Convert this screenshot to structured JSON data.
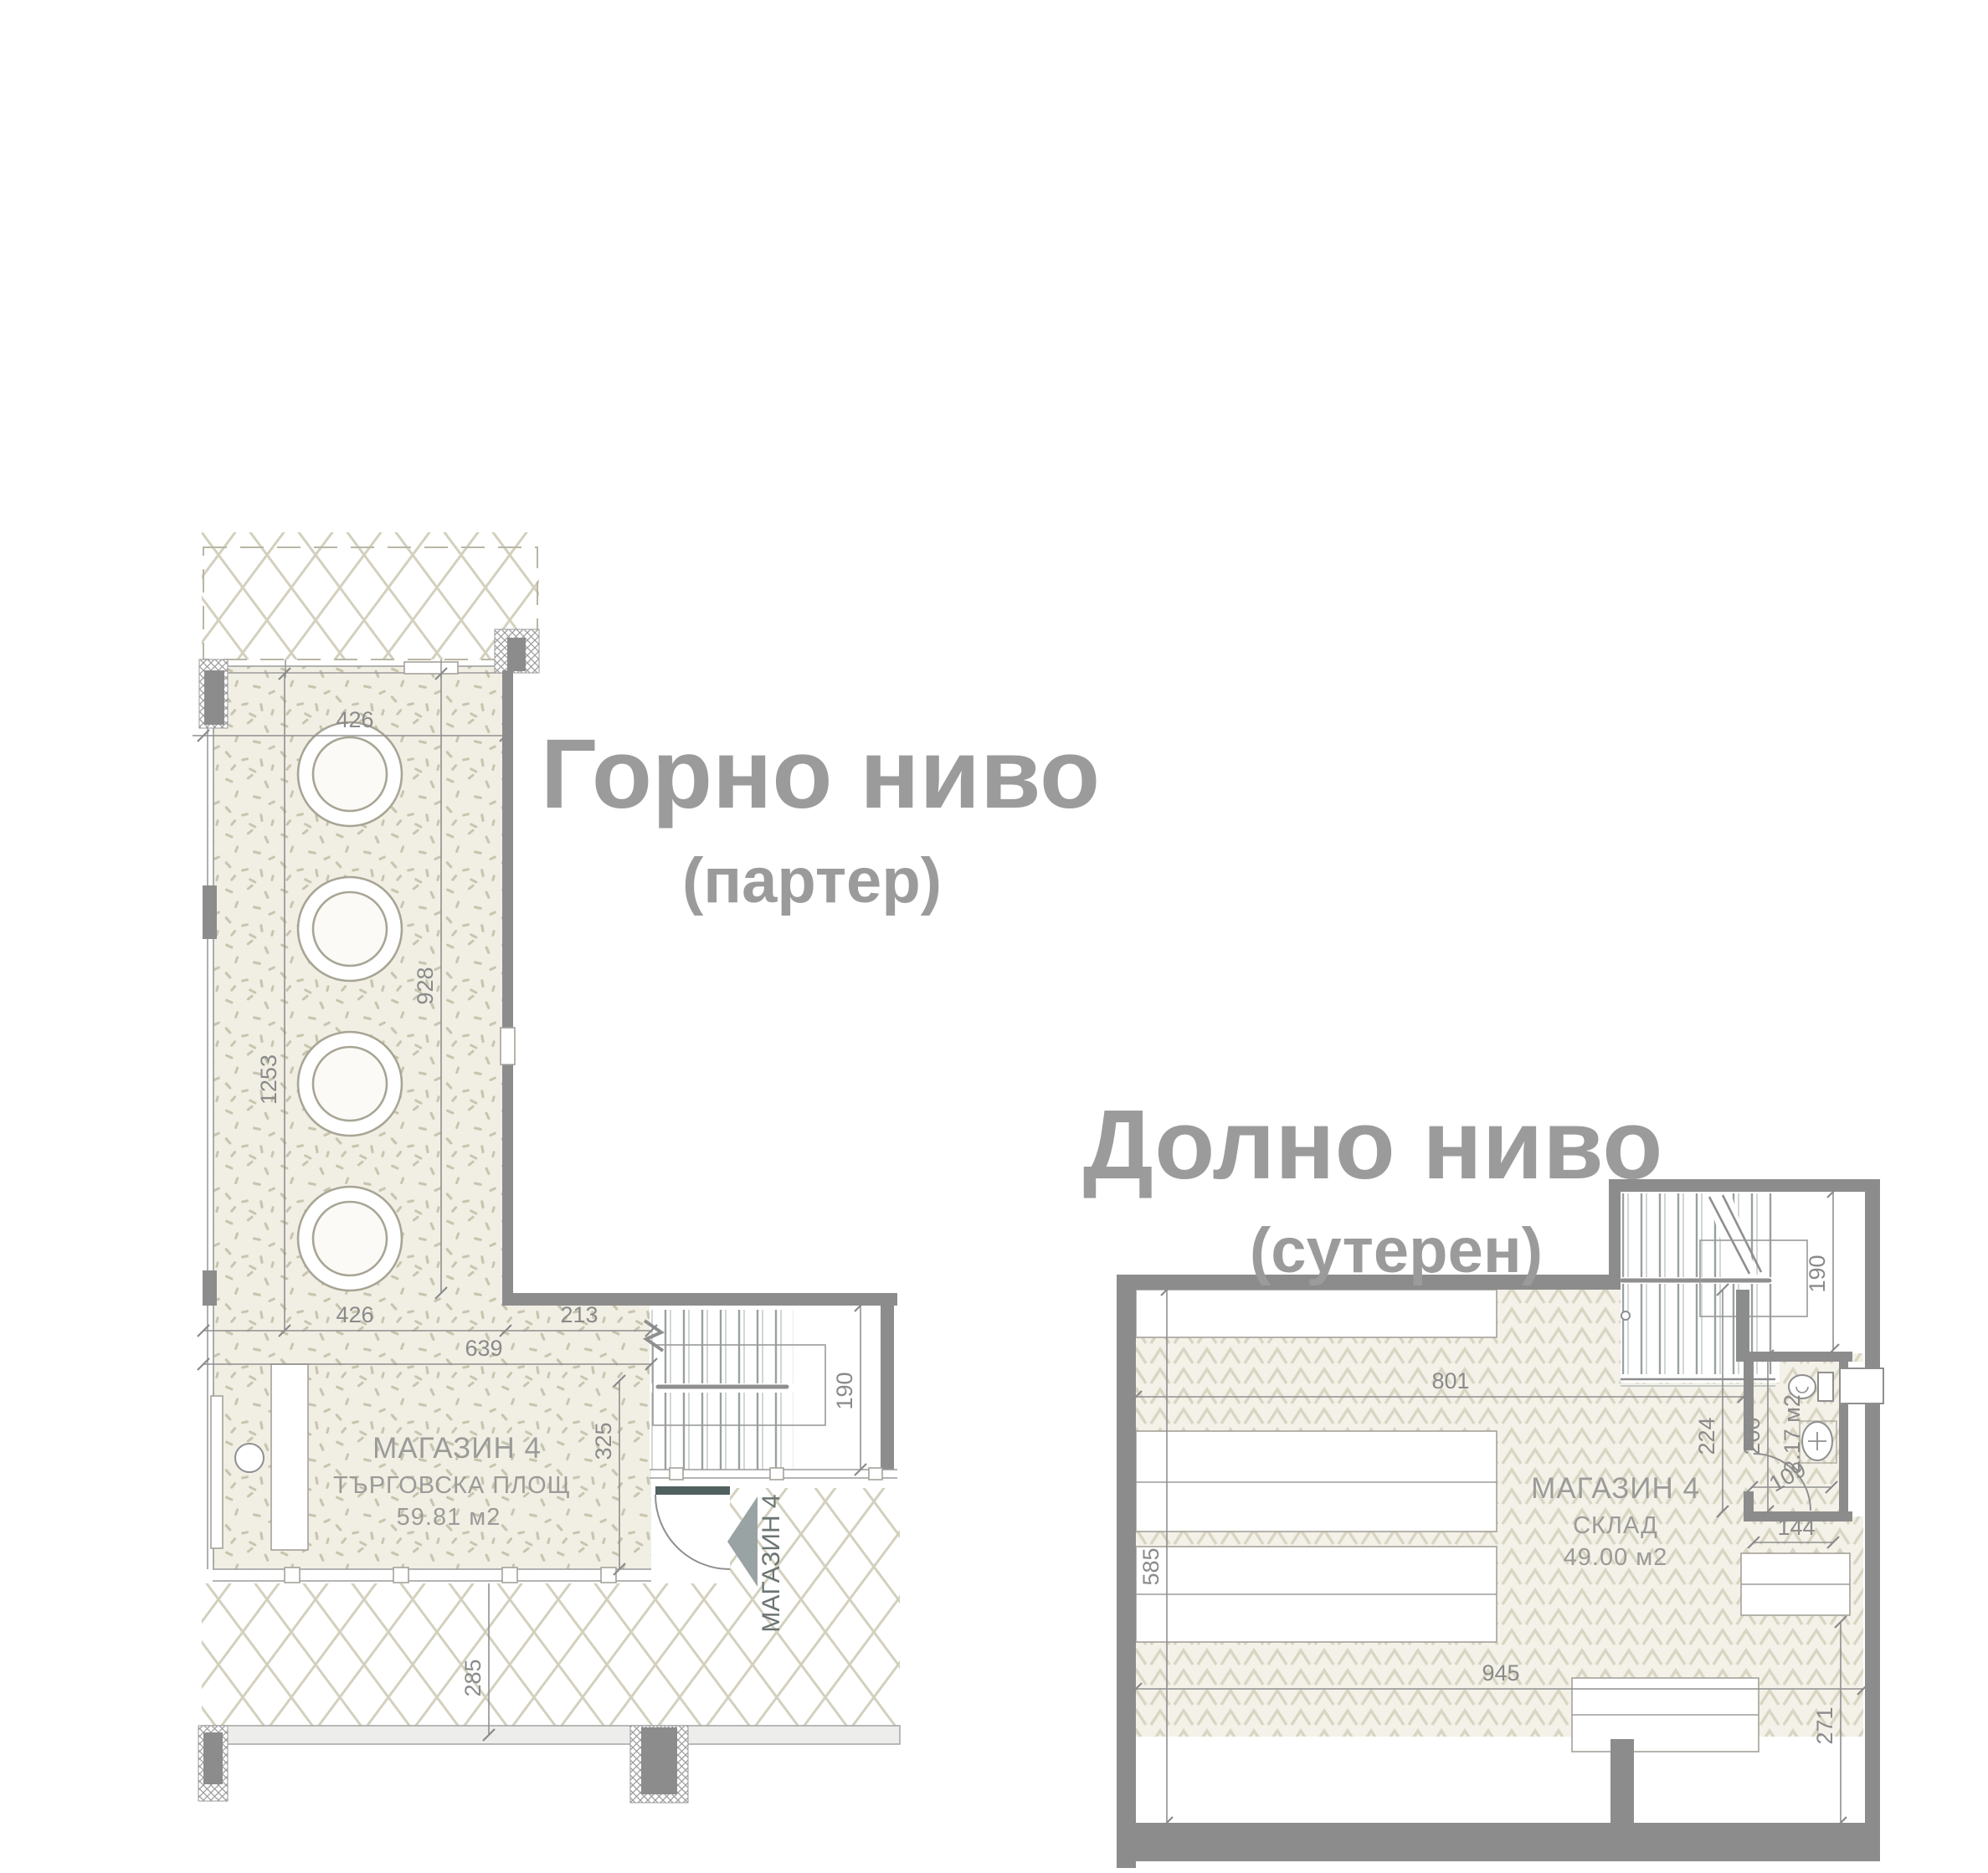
{
  "upper_plan": {
    "title": "Горно ниво",
    "subtitle": "(партер)",
    "room_name": "МАГАЗИН 4",
    "room_type": "ТЪРГОВСКА ПЛОЩ",
    "room_area": "59.81 м2",
    "entrance_label": "МАГАЗИН 4",
    "dims": {
      "top_width": "426",
      "left_height": "1253",
      "right_height": "928",
      "bottom_width_left": "426",
      "bottom_width_right": "213",
      "bottom_total": "639",
      "room_depth": "325",
      "pavement_depth": "285",
      "stair_width": "190"
    }
  },
  "lower_plan": {
    "title": "Долно ниво",
    "subtitle": "(сутерен)",
    "room_name": "МАГАЗИН 4",
    "room_type": "СКЛАД",
    "room_area": "49.00 м2",
    "wc_area": "2.17 м2",
    "dims": {
      "top_width": "801",
      "left_height": "585",
      "bottom_width": "945",
      "right_height": "271",
      "stair_width": "190",
      "wc_left": "224",
      "wc_right": "200",
      "wc_door": "109",
      "rack_width": "144"
    }
  }
}
